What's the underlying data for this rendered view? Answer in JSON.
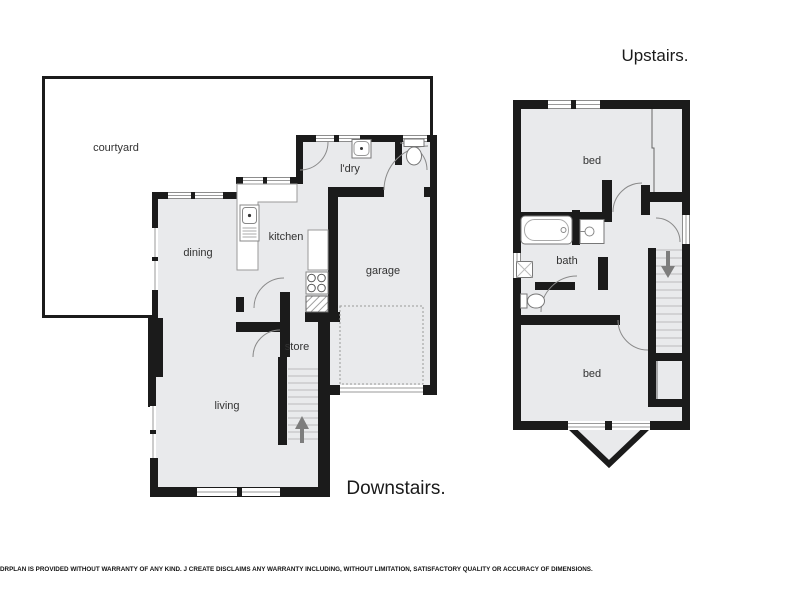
{
  "titles": {
    "upstairs": "Upstairs.",
    "downstairs": "Downstairs."
  },
  "rooms_downstairs": {
    "courtyard": "courtyard",
    "dining": "dining",
    "kitchen": "kitchen",
    "laundry": "l'dry",
    "garage": "garage",
    "store": "store",
    "living": "living"
  },
  "rooms_upstairs": {
    "bed_front": "bed",
    "bath": "bath",
    "bed_rear": "bed"
  },
  "footer": {
    "disclaimer": "DRPLAN IS PROVIDED WITHOUT WARRANTY OF ANY KIND. J CREATE DISCLAIMS ANY WARRANTY INCLUDING, WITHOUT LIMITATION, SATISFACTORY QUALITY OR ACCURACY OF DIMENSIONS."
  },
  "colors": {
    "wall": "#1b1b1b",
    "floor_fill": "#e9eaec",
    "fixture_outline": "#777777",
    "stair_arrow": "#7d7d7d",
    "window_line": "#9a9a9a"
  }
}
